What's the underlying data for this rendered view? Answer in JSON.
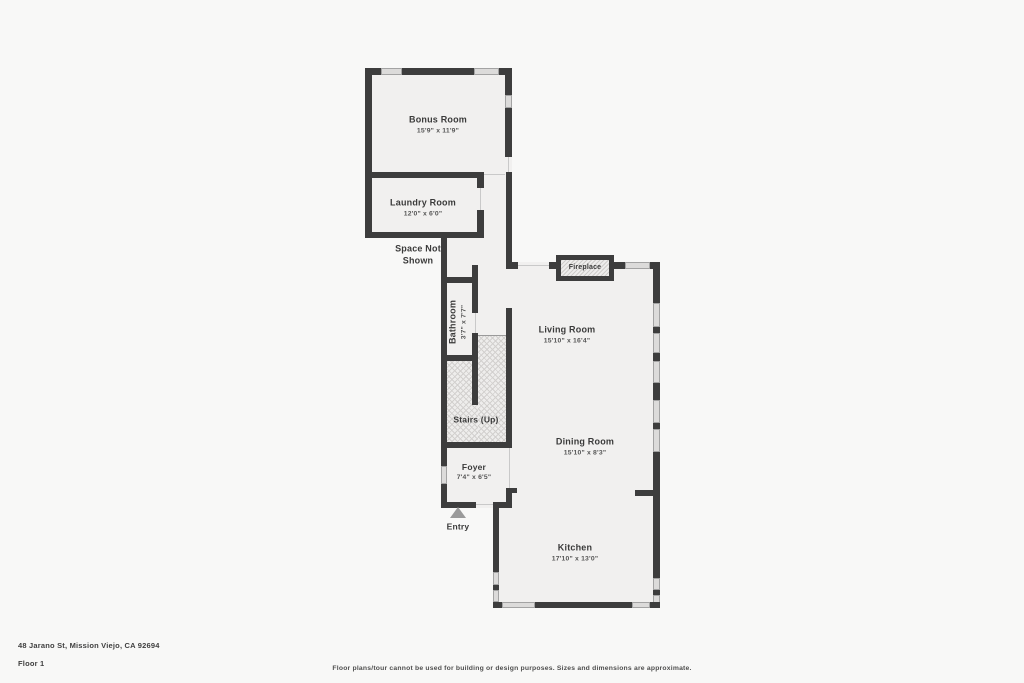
{
  "page": {
    "address": "48 Jarano St, Mission Viejo, CA 92694",
    "floor_label": "Floor 1",
    "disclaimer": "Floor plans/tour cannot be used for building or design purposes. Sizes and dimensions are approximate."
  },
  "floorplan": {
    "rooms": [
      {
        "name": "Bonus Room",
        "dims": "15'9\" x 11'9\""
      },
      {
        "name": "Laundry Room",
        "dims": "12'0\" x 6'0\""
      },
      {
        "name": "Bathroom",
        "dims": "3'7\" x 7'7\""
      },
      {
        "name": "Foyer",
        "dims": "7'4\" x 6'5\""
      },
      {
        "name": "Living Room",
        "dims": "15'10\" x 16'4\""
      },
      {
        "name": "Dining Room",
        "dims": "15'10\" x 8'3\""
      },
      {
        "name": "Kitchen",
        "dims": "17'10\" x 13'0\""
      }
    ],
    "labels": {
      "space_not_shown_line1": "Space Not",
      "space_not_shown_line2": "Shown",
      "stairs": "Stairs (Up)",
      "entry": "Entry",
      "fireplace": "Fireplace"
    },
    "colors": {
      "wall": "#3d3d3d",
      "floor": "#f1f0ef",
      "window": "#dcdbda",
      "background": "#f8f8f7",
      "entry_arrow": "#9a9a9a"
    }
  }
}
